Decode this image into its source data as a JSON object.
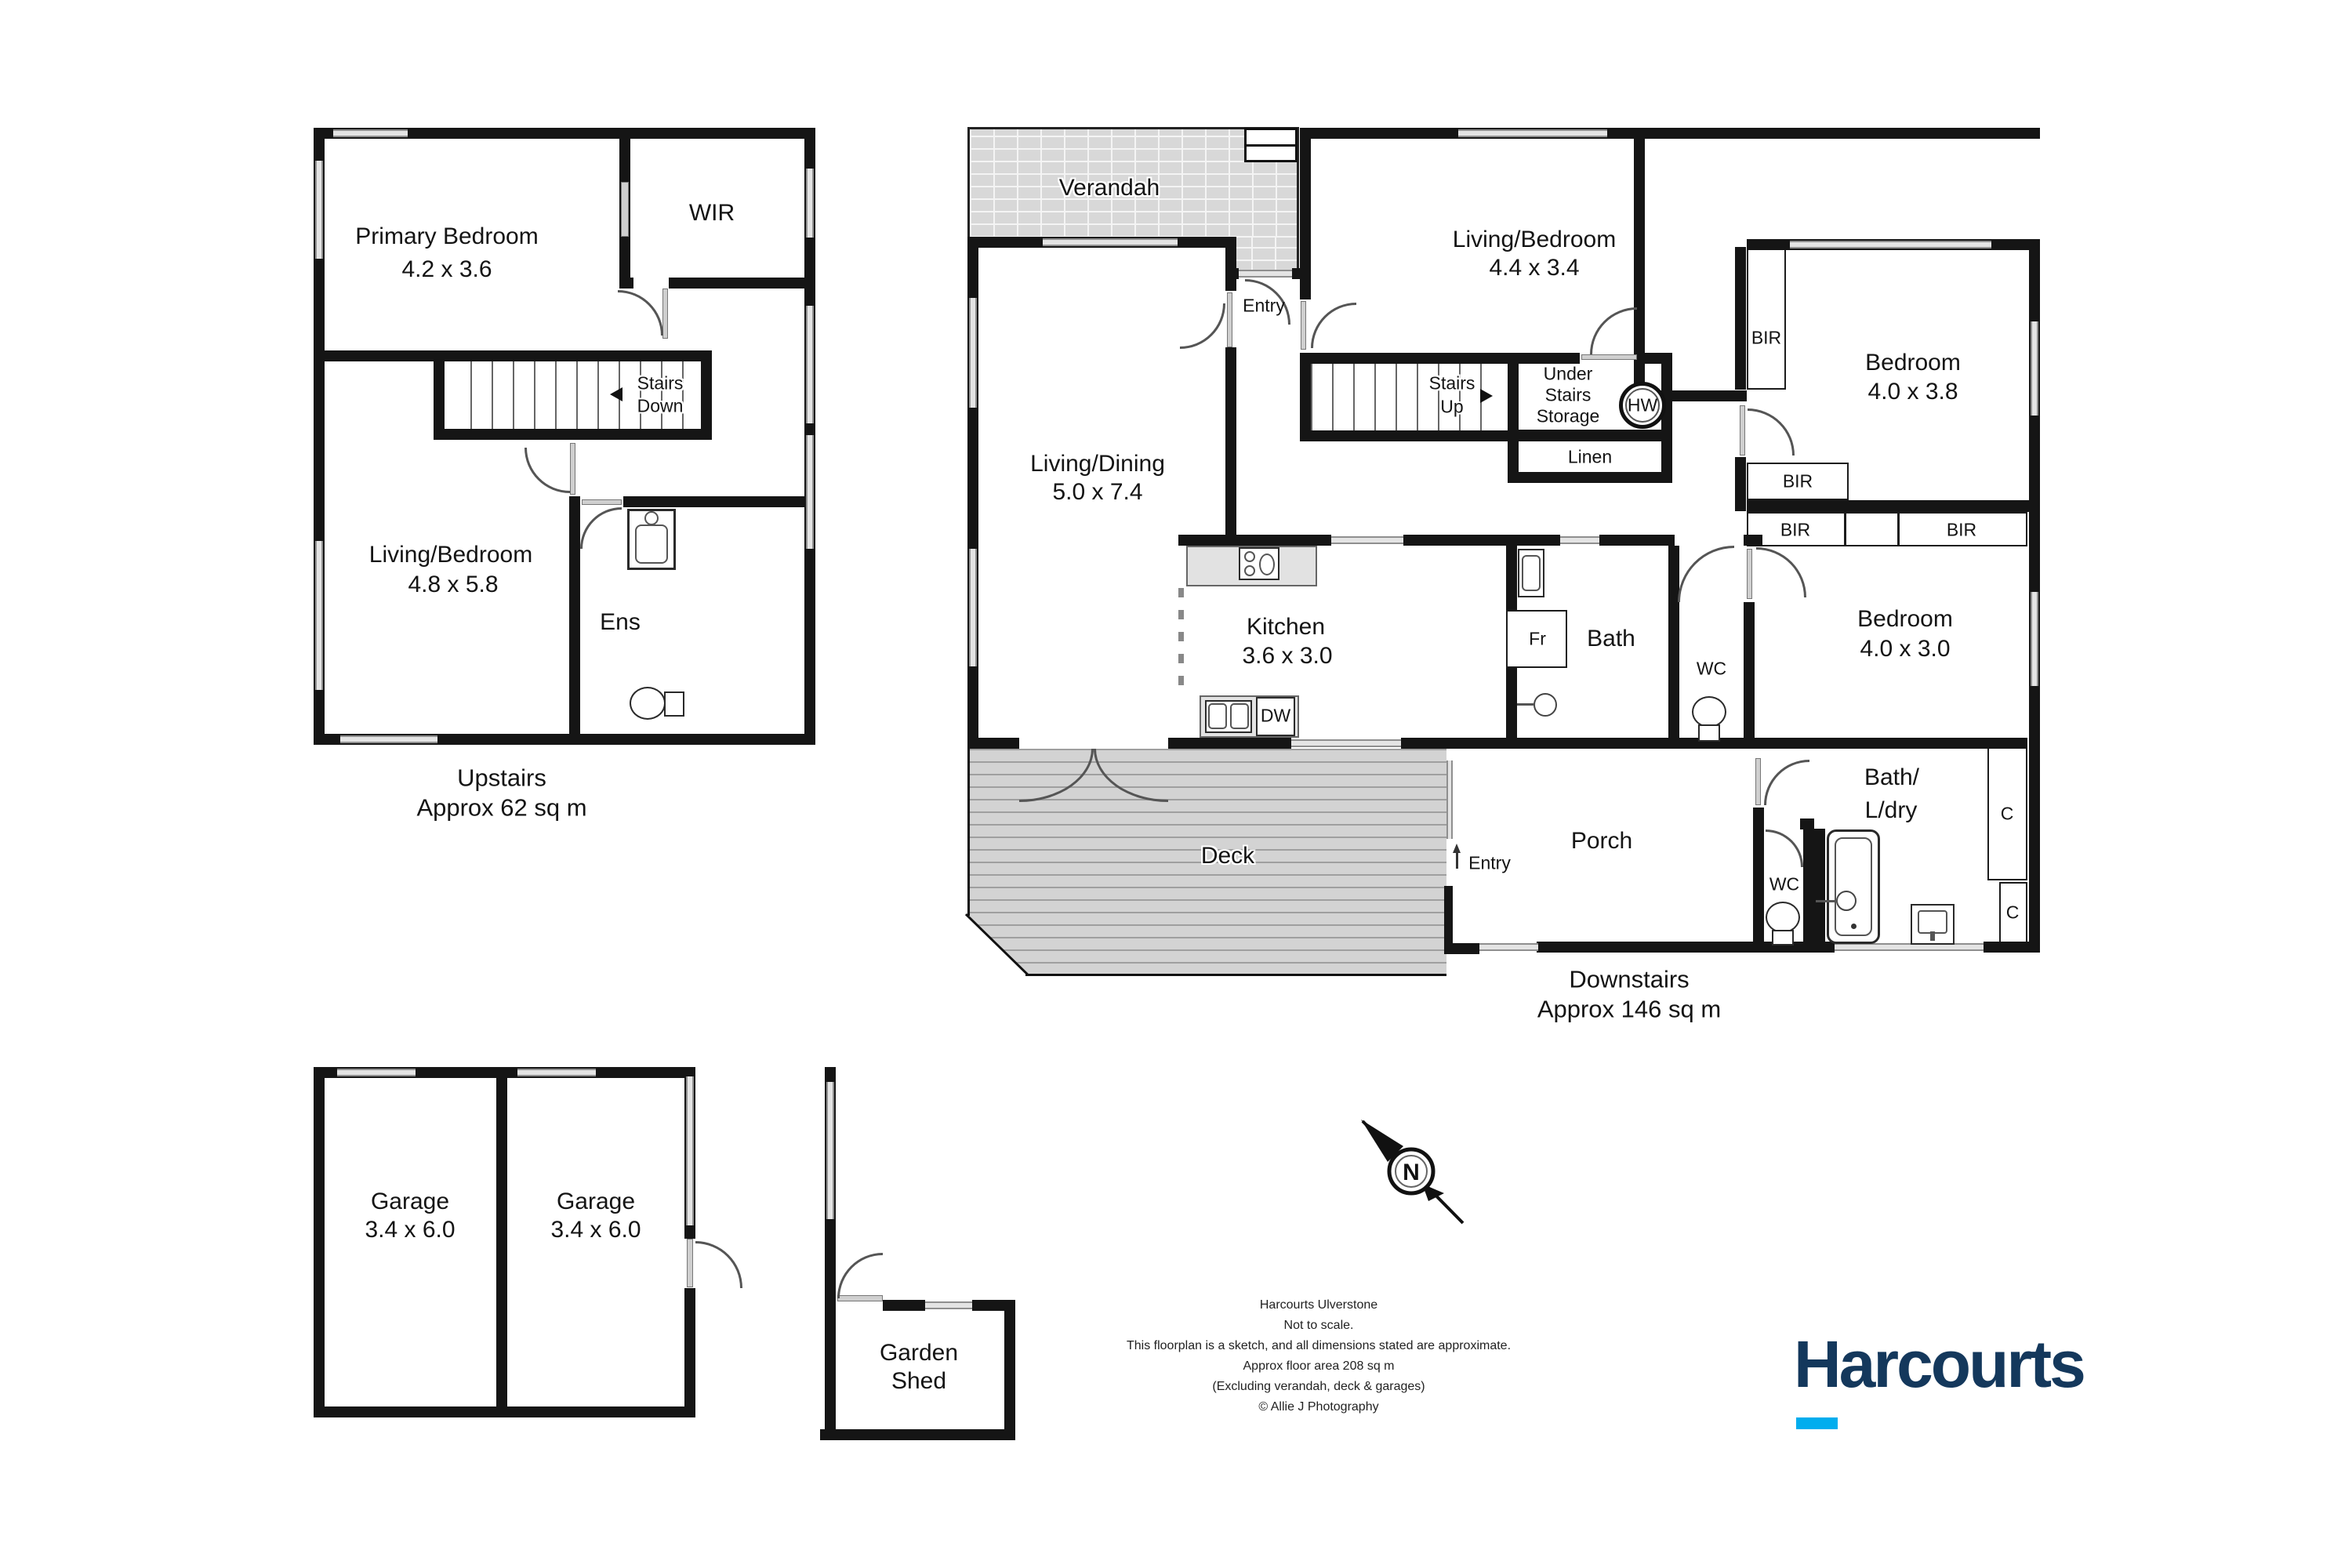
{
  "floors": {
    "upstairs": {
      "caption_line1": "Upstairs",
      "caption_line2": "Approx 62 sq m",
      "rooms": {
        "primary_bedroom": {
          "name": "Primary Bedroom",
          "dims": "4.2 x 3.6"
        },
        "wir": {
          "name": "WIR"
        },
        "stairs_down": {
          "line1": "Stairs",
          "line2": "Down"
        },
        "living_bedroom": {
          "name": "Living/Bedroom",
          "dims": "4.8 x 5.8"
        },
        "ens": {
          "name": "Ens"
        }
      }
    },
    "downstairs": {
      "caption_line1": "Downstairs",
      "caption_line2": "Approx 146 sq m",
      "rooms": {
        "verandah": {
          "name": "Verandah"
        },
        "entry": {
          "name": "Entry"
        },
        "living_bedroom": {
          "name": "Living/Bedroom",
          "dims": "4.4 x 3.4"
        },
        "bedroom1": {
          "name": "Bedroom",
          "dims": "4.0 x 3.8"
        },
        "living_dining": {
          "name": "Living/Dining",
          "dims": "5.0 x 7.4"
        },
        "stairs_up": {
          "line1": "Stairs",
          "line2": "Up"
        },
        "under_stairs": {
          "line1": "Under",
          "line2": "Stairs",
          "line3": "Storage"
        },
        "linen": {
          "name": "Linen"
        },
        "kitchen": {
          "name": "Kitchen",
          "dims": "3.6 x 3.0"
        },
        "bath": {
          "name": "Bath"
        },
        "wc": {
          "name": "WC"
        },
        "bedroom2": {
          "name": "Bedroom",
          "dims": "4.0 x 3.0"
        },
        "deck": {
          "name": "Deck"
        },
        "porch": {
          "name": "Porch"
        },
        "bath_ldry": {
          "line1": "Bath/",
          "line2": "L/dry"
        }
      },
      "fixtures": {
        "bir": "BIR",
        "hw": "HW",
        "fr": "Fr",
        "dw": "DW",
        "closet": "C"
      }
    },
    "garage": {
      "garage1": {
        "name": "Garage",
        "dims": "3.4 x 6.0"
      },
      "garage2": {
        "name": "Garage",
        "dims": "3.4 x 6.0"
      },
      "shed": {
        "line1": "Garden",
        "line2": "Shed"
      }
    }
  },
  "compass": {
    "label": "N"
  },
  "footer": {
    "line1": "Harcourts Ulverstone",
    "line2": "Not to scale.",
    "line3": "This floorplan is a sketch, and all dimensions stated are approximate.",
    "line4": "Approx floor area 208 sq m",
    "line5": "(Excluding verandah, deck & garages)",
    "line6": "©  Allie J Photography"
  },
  "brand": {
    "name": "Harcourts",
    "color": "#14385c",
    "accent_color": "#00adee"
  }
}
